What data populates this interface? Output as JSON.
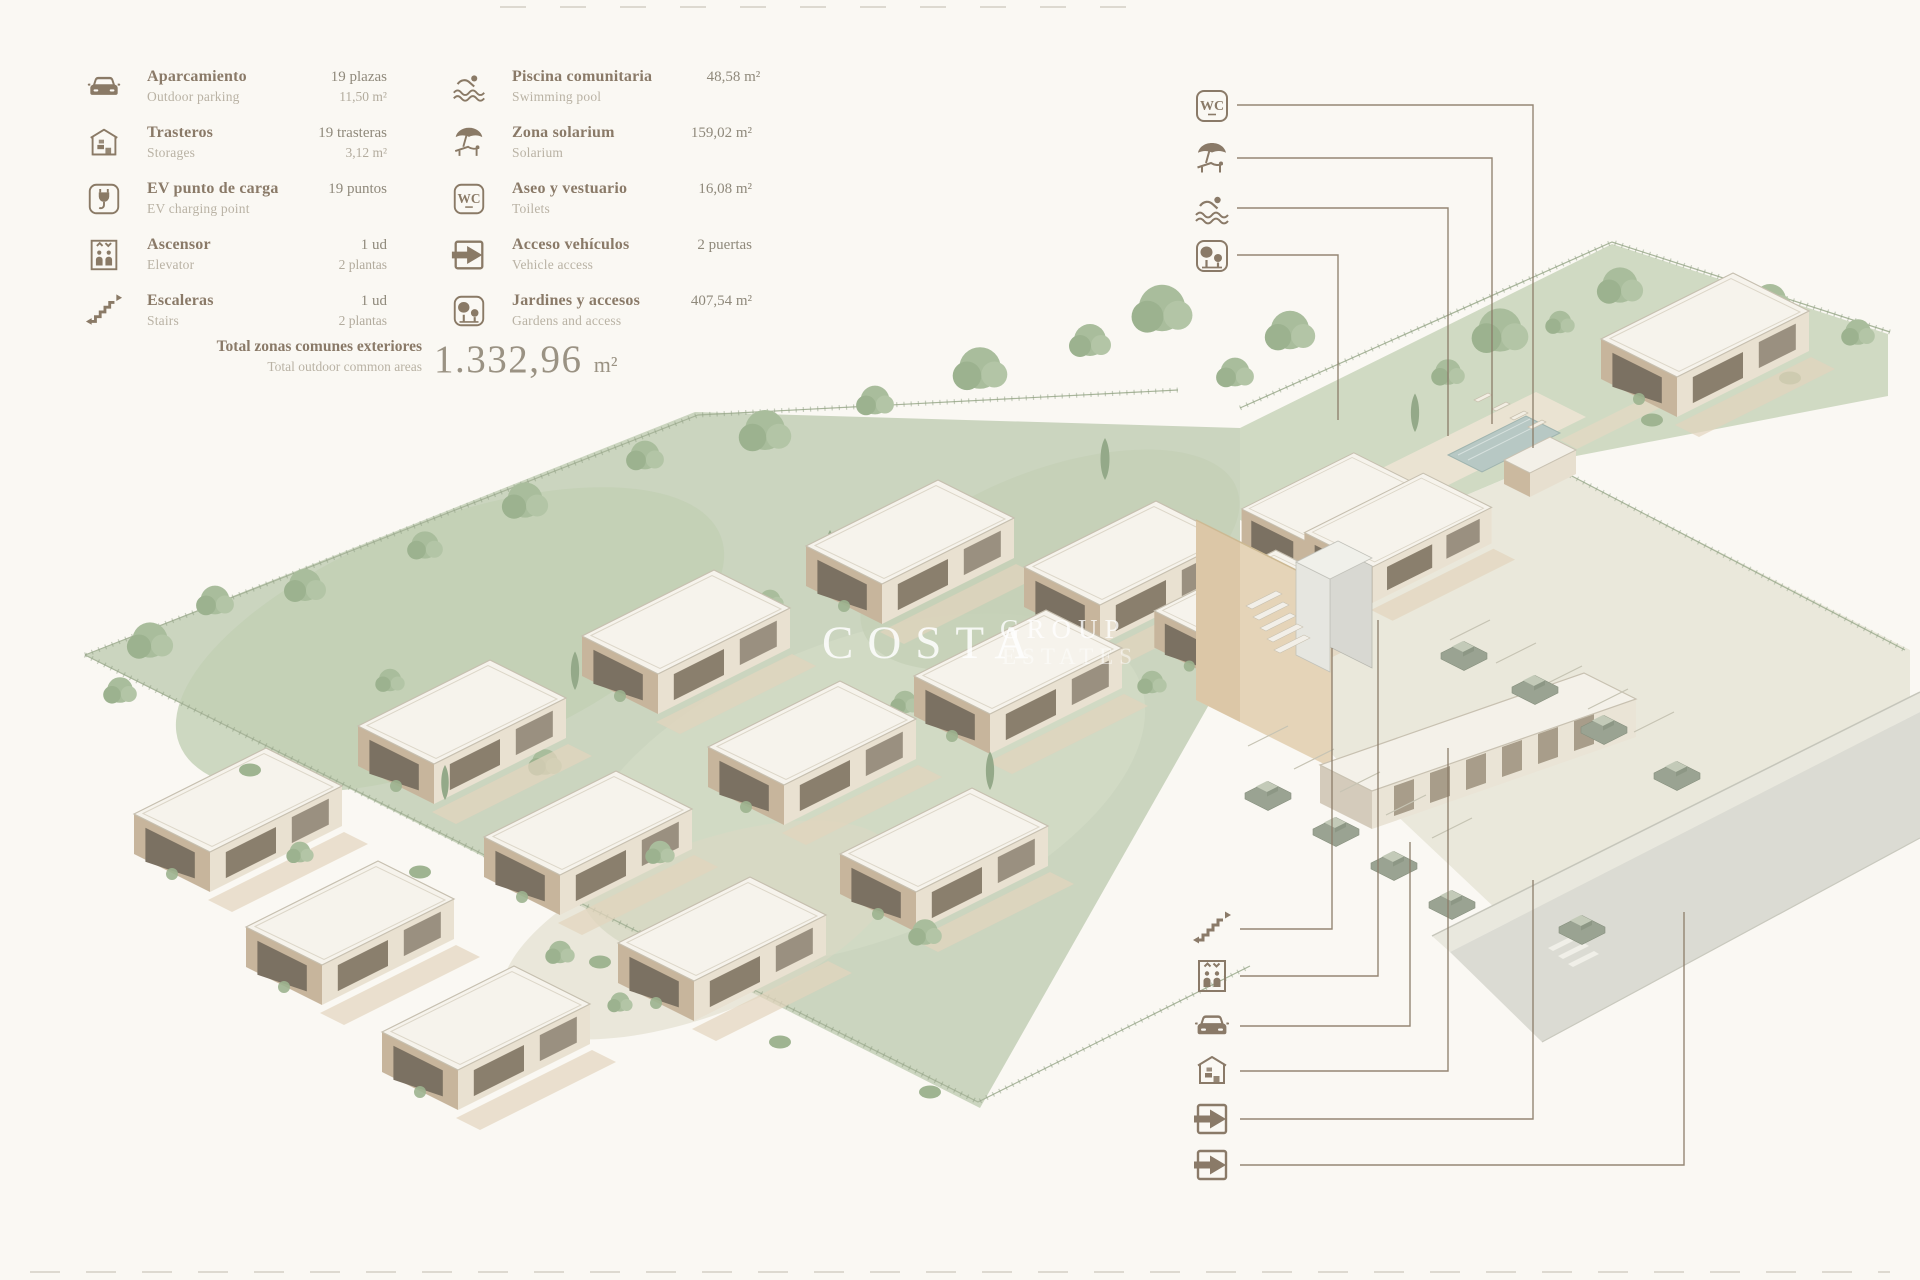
{
  "watermark": {
    "primary": "COSTA",
    "secondary": "GROUP",
    "tertiary": "ESTATES"
  },
  "legend": {
    "columns": [
      {
        "items": [
          {
            "icon": "car",
            "name_es": "Aparcamiento",
            "name_en": "Outdoor parking",
            "value_line1": "19 plazas",
            "value_line2": "11,50 m²"
          },
          {
            "icon": "storage",
            "name_es": "Trasteros",
            "name_en": "Storages",
            "value_line1": "19 trasteras",
            "value_line2": "3,12 m²"
          },
          {
            "icon": "ev-charger",
            "name_es": "EV punto de carga",
            "name_en": "EV charging point",
            "value_line1": "19 puntos",
            "value_line2": ""
          },
          {
            "icon": "elevator",
            "name_es": "Ascensor",
            "name_en": "Elevator",
            "value_line1": "1 ud",
            "value_line2": "2 plantas"
          },
          {
            "icon": "stairs",
            "name_es": "Escaleras",
            "name_en": "Stairs",
            "value_line1": "1 ud",
            "value_line2": "2 plantas"
          }
        ]
      },
      {
        "items": [
          {
            "icon": "pool",
            "name_es": "Piscina comunitaria",
            "name_en": "Swimming pool",
            "value_line1": "48,58 m²",
            "value_line2": ""
          },
          {
            "icon": "solarium",
            "name_es": "Zona solarium",
            "name_en": "Solarium",
            "value_line1": "159,02 m²",
            "value_line2": ""
          },
          {
            "icon": "wc",
            "name_es": "Aseo y vestuario",
            "name_en": "Toilets",
            "value_line1": "16,08 m²",
            "value_line2": ""
          },
          {
            "icon": "vehicle-access",
            "name_es": "Acceso vehículos",
            "name_en": "Vehicle access",
            "value_line1": "2 puertas",
            "value_line2": ""
          },
          {
            "icon": "garden",
            "name_es": "Jardines y accesos",
            "name_en": "Gardens and access",
            "value_line1": "407,54 m²",
            "value_line2": ""
          }
        ]
      }
    ],
    "total": {
      "label_es": "Total zonas comunes exteriores",
      "label_en": "Total outdoor common areas",
      "value": "1.332,96",
      "unit": "m²"
    }
  },
  "plan_callouts": {
    "top": [
      "wc",
      "solarium",
      "pool",
      "garden"
    ],
    "bottom": [
      "stairs",
      "elevator",
      "car",
      "storage",
      "vehicle-access",
      "vehicle-access"
    ]
  },
  "colors": {
    "icon_brown": "#8a7a66",
    "text_secondary": "#b9b2a4",
    "background": "#faf8f3",
    "vegetation_green": "#cbd5bf",
    "tree_green": "#a9bd9c",
    "roof_white": "#f6f3ec",
    "facade_tan": "#c7b59c",
    "pool_water": "#b7c8c4",
    "road_grey": "#dbdbd3",
    "leader_line": "#8a7a66"
  }
}
